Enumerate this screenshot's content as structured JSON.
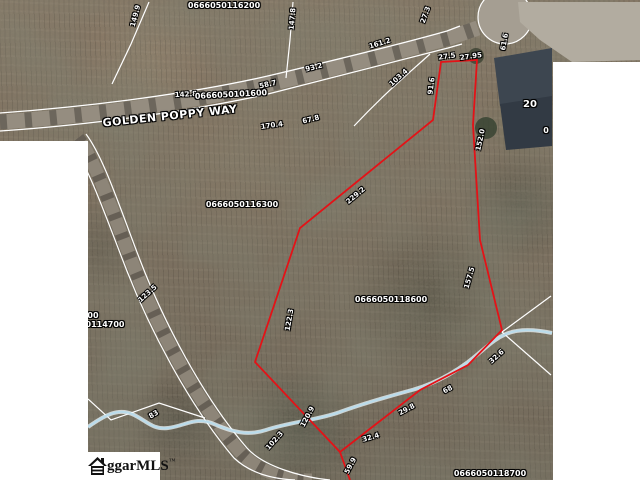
{
  "map": {
    "road_label": "GOLDEN POPPY WAY",
    "house_number": "20",
    "highlighted_parcel_id": "0666050118600",
    "colors": {
      "highlight_red": "#e41217",
      "boundary_white": "#ffffff",
      "stream_blue": "#b9dcec"
    },
    "labels": [
      {
        "text": "0666050116200",
        "x": 224,
        "y": 6,
        "rot": 0,
        "s": 8,
        "kind": "parcel"
      },
      {
        "text": "149.9",
        "x": 136,
        "y": 16,
        "rot": -75,
        "s": 7,
        "kind": "dim"
      },
      {
        "text": "147.8",
        "x": 293,
        "y": 19,
        "rot": -85,
        "s": 7,
        "kind": "dim"
      },
      {
        "text": "27.3",
        "x": 426,
        "y": 15,
        "rot": -70,
        "s": 7,
        "kind": "dim"
      },
      {
        "text": "161.2",
        "x": 380,
        "y": 44,
        "rot": -17,
        "s": 7,
        "kind": "dim"
      },
      {
        "text": "61.6",
        "x": 505,
        "y": 42,
        "rot": -80,
        "s": 7,
        "kind": "dim"
      },
      {
        "text": "93.2",
        "x": 314,
        "y": 68,
        "rot": -14,
        "s": 7,
        "kind": "dim"
      },
      {
        "text": "58.7",
        "x": 268,
        "y": 85,
        "rot": -13,
        "s": 7,
        "kind": "dim"
      },
      {
        "text": "103.4",
        "x": 399,
        "y": 78,
        "rot": -42,
        "s": 7,
        "kind": "dim"
      },
      {
        "text": "91.6",
        "x": 432,
        "y": 86,
        "rot": -83,
        "s": 7,
        "kind": "dim"
      },
      {
        "text": "27.5",
        "x": 447,
        "y": 57,
        "rot": -8,
        "s": 7,
        "kind": "dim"
      },
      {
        "text": "27.95",
        "x": 471,
        "y": 57,
        "rot": -8,
        "s": 7,
        "kind": "dim"
      },
      {
        "text": "142.8",
        "x": 186,
        "y": 95,
        "rot": -3,
        "s": 7,
        "kind": "dim"
      },
      {
        "text": "0666050101600",
        "x": 231,
        "y": 95,
        "rot": -3,
        "s": 8,
        "kind": "parcel"
      },
      {
        "text": "GOLDEN POPPY WAY",
        "x": 170,
        "y": 116,
        "rot": -6,
        "s": 11,
        "kind": "road"
      },
      {
        "text": "67.8",
        "x": 311,
        "y": 120,
        "rot": -14,
        "s": 7,
        "kind": "dim"
      },
      {
        "text": "170.4",
        "x": 272,
        "y": 126,
        "rot": -8,
        "s": 7,
        "kind": "dim"
      },
      {
        "text": "20",
        "x": 530,
        "y": 105,
        "rot": 0,
        "s": 10,
        "kind": "house"
      },
      {
        "text": "0",
        "x": 546,
        "y": 131,
        "rot": 0,
        "s": 8,
        "kind": "parcel"
      },
      {
        "text": "152.0",
        "x": 481,
        "y": 140,
        "rot": -78,
        "s": 7,
        "kind": "dim"
      },
      {
        "text": "229.2",
        "x": 356,
        "y": 196,
        "rot": -40,
        "s": 7,
        "kind": "dim"
      },
      {
        "text": "0666050116300",
        "x": 242,
        "y": 205,
        "rot": 0,
        "s": 8,
        "kind": "parcel"
      },
      {
        "text": "157.5",
        "x": 470,
        "y": 278,
        "rot": -74,
        "s": 7,
        "kind": "dim"
      },
      {
        "text": "122.3",
        "x": 290,
        "y": 320,
        "rot": -80,
        "s": 7,
        "kind": "dim"
      },
      {
        "text": "123.5",
        "x": 148,
        "y": 294,
        "rot": -42,
        "s": 7,
        "kind": "dim"
      },
      {
        "text": "0666050118600",
        "x": 391,
        "y": 300,
        "rot": 0,
        "s": 8,
        "kind": "parcel"
      },
      {
        "text": "00",
        "x": 93,
        "y": 316,
        "rot": 0,
        "s": 8,
        "kind": "parcel"
      },
      {
        "text": "0114700",
        "x": 105,
        "y": 325,
        "rot": 0,
        "s": 8,
        "kind": "parcel"
      },
      {
        "text": "83",
        "x": 154,
        "y": 415,
        "rot": -30,
        "s": 7,
        "kind": "dim"
      },
      {
        "text": "102.3",
        "x": 275,
        "y": 441,
        "rot": -48,
        "s": 7,
        "kind": "dim"
      },
      {
        "text": "120.9",
        "x": 308,
        "y": 417,
        "rot": -62,
        "s": 7,
        "kind": "dim"
      },
      {
        "text": "59.9",
        "x": 351,
        "y": 466,
        "rot": -62,
        "s": 7,
        "kind": "dim"
      },
      {
        "text": "32.4",
        "x": 371,
        "y": 438,
        "rot": -16,
        "s": 7,
        "kind": "dim"
      },
      {
        "text": "29.8",
        "x": 407,
        "y": 410,
        "rot": -28,
        "s": 7,
        "kind": "dim"
      },
      {
        "text": "68",
        "x": 448,
        "y": 390,
        "rot": -28,
        "s": 7,
        "kind": "dim"
      },
      {
        "text": "32.6",
        "x": 497,
        "y": 357,
        "rot": -42,
        "s": 7,
        "kind": "dim"
      },
      {
        "text": "0666050118700",
        "x": 490,
        "y": 474,
        "rot": 0,
        "s": 8,
        "kind": "parcel"
      }
    ]
  },
  "watermark": {
    "text": "ggarMLS",
    "trademark": "™"
  }
}
